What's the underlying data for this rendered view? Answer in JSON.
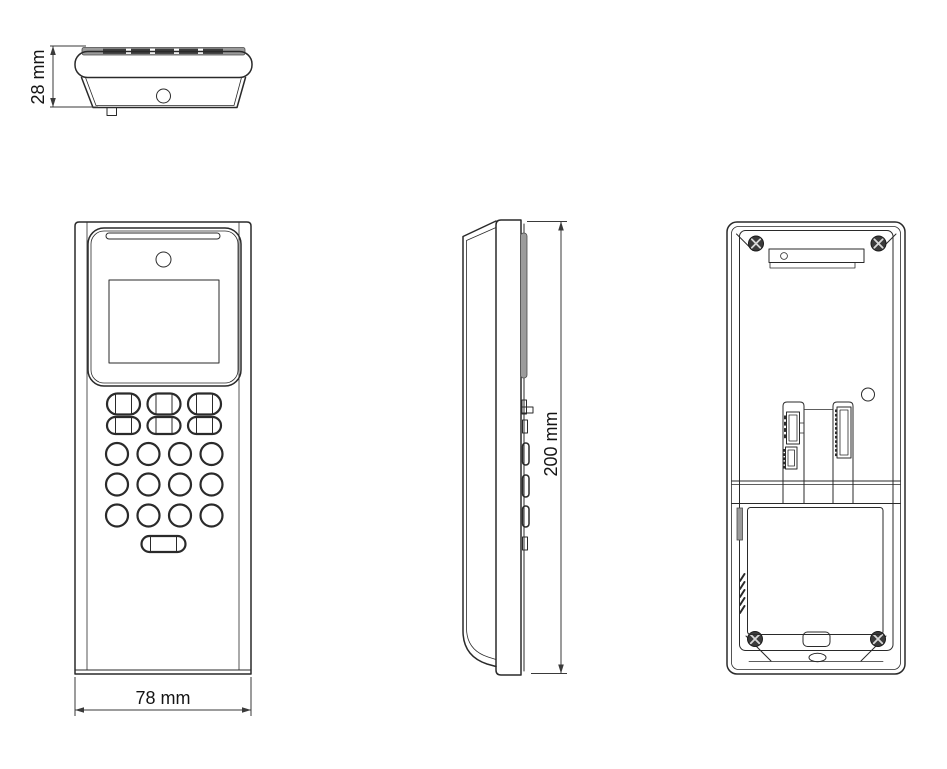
{
  "drawing": {
    "kind": "orthographic-technical-drawing",
    "views": {
      "top_view": "device seen from above",
      "front_view": "device front with screen and keypad",
      "side_view": "device left profile",
      "back_view": "device rear mounting plate"
    },
    "keypad": {
      "oval_key_rows": 2,
      "oval_keys_per_row": 3,
      "round_key_rows": 3,
      "round_keys_per_row": 4,
      "wide_bottom_keys": 1
    }
  },
  "dimensions": {
    "depth_label": "28 mm",
    "width_label": "78 mm",
    "height_label": "200 mm"
  },
  "colors": {
    "line": "#2a2a2a",
    "dimension_line": "#3a3a3a",
    "gray_fill": "#9b9b9b",
    "dark_fill": "#3d3d3d",
    "background": "#ffffff"
  }
}
